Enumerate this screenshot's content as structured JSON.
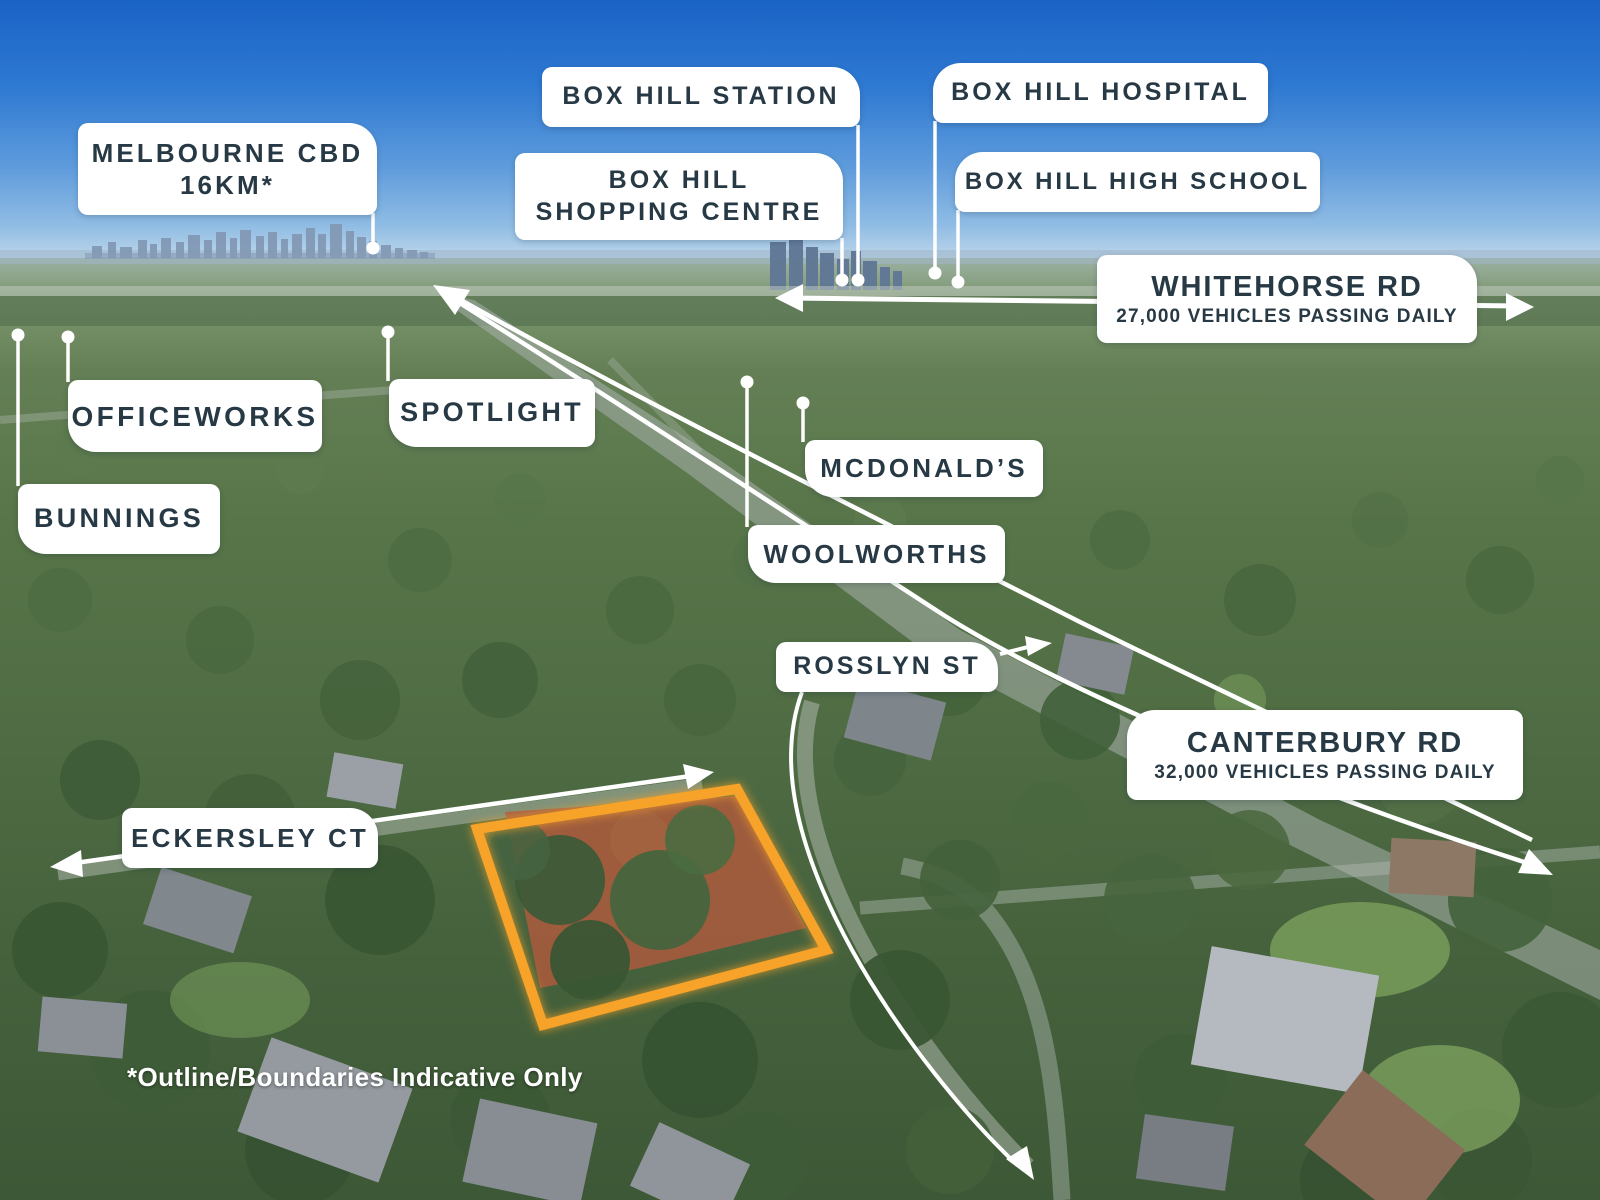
{
  "labels": {
    "melbourne_cbd": {
      "line1": "MELBOURNE CBD",
      "line2": "16KM*"
    },
    "box_hill_station": {
      "text": "BOX HILL STATION"
    },
    "box_hill_shopping_centre": {
      "line1": "BOX HILL",
      "line2": "SHOPPING CENTRE"
    },
    "box_hill_hospital": {
      "text": "BOX HILL HOSPITAL"
    },
    "box_hill_high_school": {
      "text": "BOX HILL HIGH SCHOOL"
    },
    "whitehorse_rd": {
      "line1": "WHITEHORSE RD",
      "line2": "27,000 VEHICLES PASSING DAILY"
    },
    "officeworks": {
      "text": "OFFICEWORKS"
    },
    "spotlight": {
      "text": "SPOTLIGHT"
    },
    "bunnings": {
      "text": "BUNNINGS"
    },
    "mcdonalds": {
      "text": "MCDONALD’S"
    },
    "woolworths": {
      "text": "WOOLWORTHS"
    },
    "rosslyn_st": {
      "text": "ROSSLYN ST"
    },
    "canterbury_rd": {
      "line1": "CANTERBURY RD",
      "line2": "32,000 VEHICLES PASSING DAILY"
    },
    "eckersley_ct": {
      "text": "ECKERSLEY CT"
    }
  },
  "disclaimer": "*Outline/Boundaries Indicative Only",
  "icons": {
    "arrow_head": "triangle",
    "connector_dot": "circle"
  },
  "colors": {
    "label_bg": "#FFFFFF",
    "label_text": "#273944",
    "marker_white": "#FFFFFF",
    "plot_outline": "#F7A229",
    "sky_top": "#1A63C6"
  }
}
